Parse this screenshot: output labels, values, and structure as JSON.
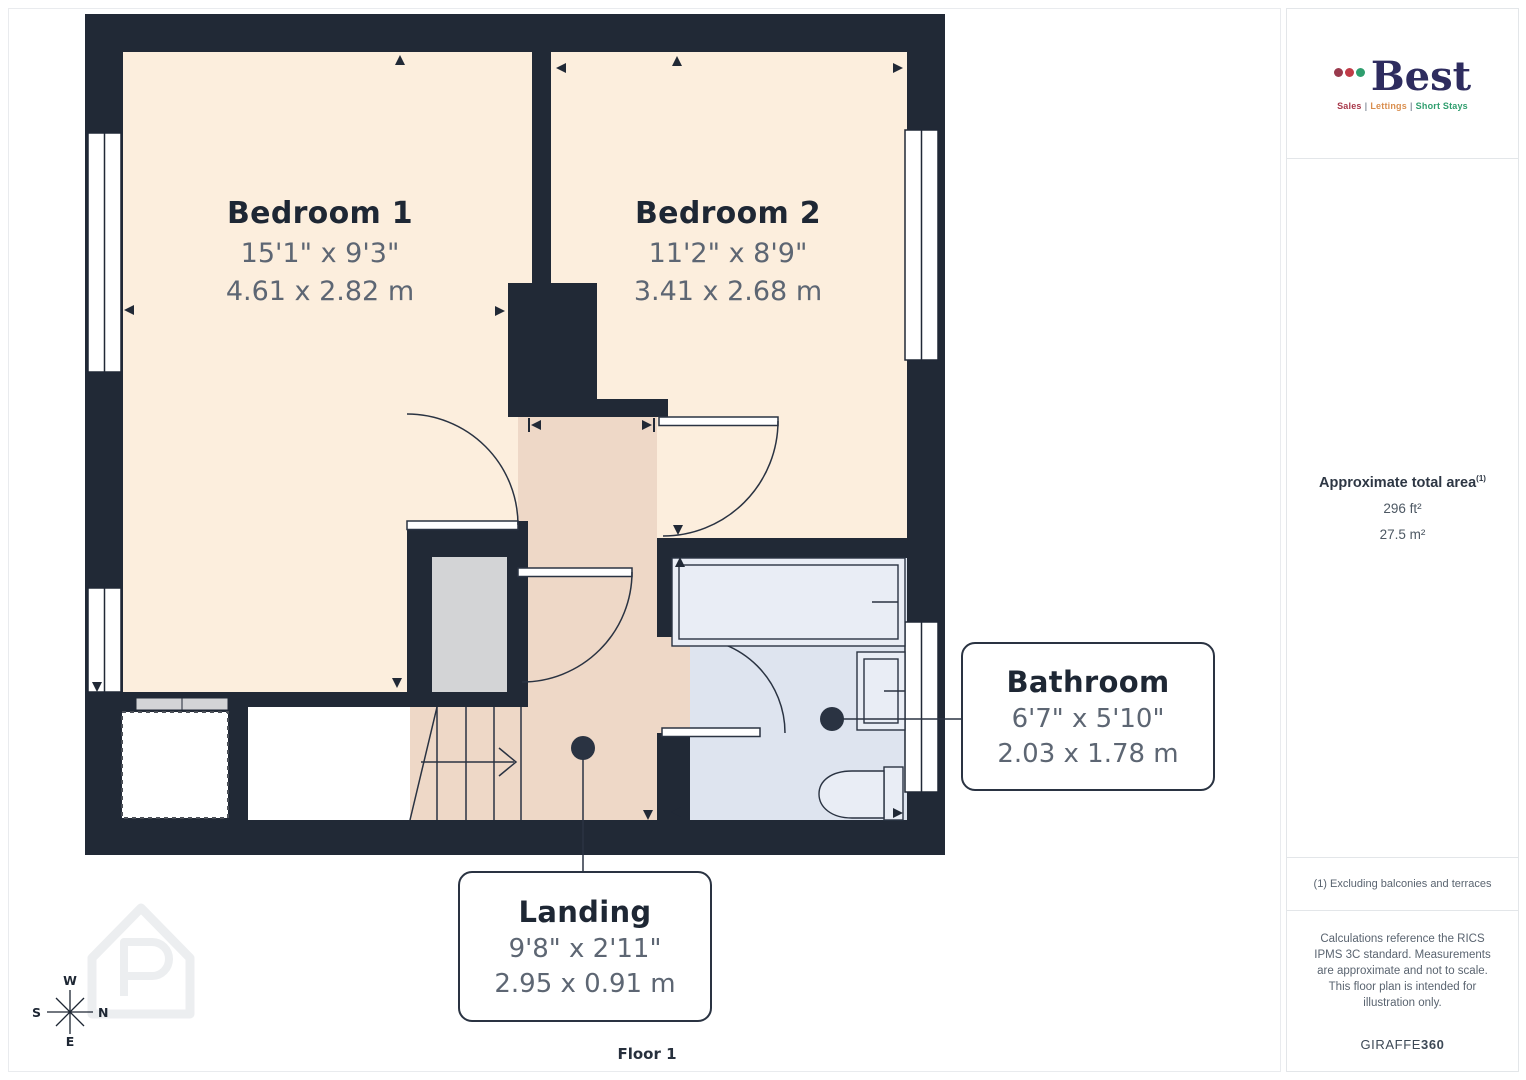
{
  "floor_plan": {
    "floor_label": "Floor 1",
    "rooms": [
      {
        "name": "Bedroom 1",
        "dims_imperial": "15'1\" x 9'3\"",
        "dims_metric": "4.61 x 2.82 m"
      },
      {
        "name": "Bedroom 2",
        "dims_imperial": "11'2\" x 8'9\"",
        "dims_metric": "3.41 x 2.68 m"
      },
      {
        "name": "Bathroom",
        "dims_imperial": "6'7\" x 5'10\"",
        "dims_metric": "2.03 x 1.78 m"
      },
      {
        "name": "Landing",
        "dims_imperial": "9'8\" x 2'11\"",
        "dims_metric": "2.95 x 0.91 m"
      }
    ],
    "compass": {
      "top": "W",
      "left": "S",
      "right": "N",
      "bottom": "E"
    }
  },
  "sidebar": {
    "logo": {
      "name": "Best",
      "separator": "|",
      "tagline": [
        "Sales",
        "Lettings",
        "Short Stays"
      ]
    },
    "area": {
      "title": "Approximate total area",
      "superscript": "(1)",
      "imperial": "296 ft²",
      "metric": "27.5 m²"
    },
    "footnote": "(1) Excluding balconies and terraces",
    "disclaimer": "Calculations reference the RICS IPMS 3C standard. Measurements are approximate and not to scale. This floor plan is intended for illustration only.",
    "brand": {
      "normal": "GIRAFFE",
      "bold": "360"
    }
  },
  "colors": {
    "wall": "#212936",
    "bedroom_fill": "#fceedd",
    "landing_fill": "#eed8c7",
    "bathroom_fill": "#dee4ef",
    "fixture_fill": "#e9edf5",
    "closet_fill": "#d3d4d6",
    "line": "#2a3342",
    "logo_navy": "#2e2c5f",
    "dot_colors": [
      "#993a4d",
      "#c13b47",
      "#2f9e6e"
    ],
    "tagline_colors": [
      "#a8384a",
      "#d98e4e",
      "#2f9e6e"
    ]
  }
}
